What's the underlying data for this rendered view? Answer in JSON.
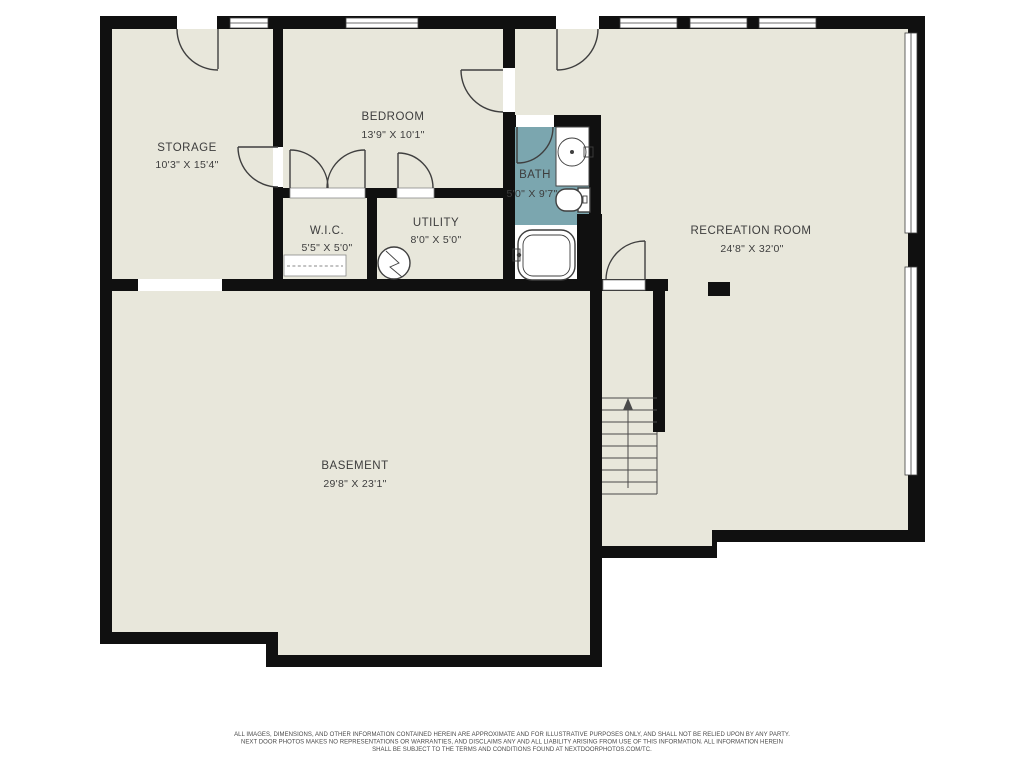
{
  "title": "Basement floor plan",
  "colors": {
    "bg": "#ffffff",
    "wall": "#101010",
    "floor": "#e8e7db",
    "bath": "#7ba6af",
    "line": "#3f3f3f",
    "text": "#3d3d3d"
  },
  "rooms": [
    {
      "name": "STORAGE",
      "dims": "10'3\" X 15'4\""
    },
    {
      "name": "BEDROOM",
      "dims": "13'9\" X 10'1\""
    },
    {
      "name": "W.I.C.",
      "dims": "5'5\" X 5'0\""
    },
    {
      "name": "UTILITY",
      "dims": "8'0\" X 5'0\""
    },
    {
      "name": "BATH",
      "dims": "5'0\" X 9'7\""
    },
    {
      "name": "RECREATION ROOM",
      "dims": "24'8\" X 32'0\""
    },
    {
      "name": "BASEMENT",
      "dims": "29'8\" X 23'1\""
    }
  ],
  "footer": {
    "line1": "ALL IMAGES, DIMENSIONS, AND OTHER INFORMATION CONTAINED HEREIN ARE APPROXIMATE AND FOR ILLUSTRATIVE PURPOSES ONLY, AND SHALL NOT BE RELIED UPON BY ANY PARTY.",
    "line2": "NEXT DOOR PHOTOS MAKES NO REPRESENTATIONS OR WARRANTIES, AND DISCLAIMS ANY AND ALL LIABILITY ARISING FROM USE OF THIS INFORMATION. ALL INFORMATION HEREIN",
    "line3": "SHALL BE SUBJECT TO THE TERMS AND CONDITIONS FOUND AT NEXTDOORPHOTOS.COM/TC."
  }
}
